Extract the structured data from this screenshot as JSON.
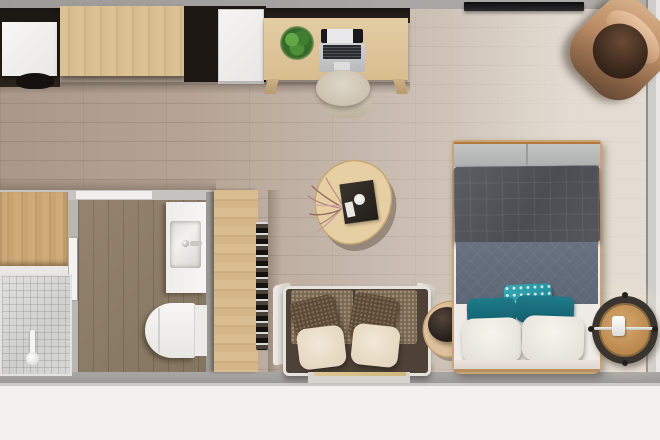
{
  "scene": {
    "title": "Studio apartment top-down 3D floor plan render",
    "view": "bird's-eye interior render, no visible text"
  },
  "palette": {
    "wall_gray": "#a3a19e",
    "wall_light": "#cfcdca",
    "outside_white": "#f2f1ef",
    "floor_main": "#b5a496",
    "floor_light_right": "#dad3ca",
    "floor_bathroom": "#8a7b6c",
    "wood_light": "#d8bd90",
    "dark_unit": "#241f1a",
    "white_fixture": "#f2f1ef",
    "marble_tile": "#dbdbd9",
    "tv_black": "#17171a",
    "armchair_tan": "#b98a63",
    "sofa_tweed_brown": "#7c6952",
    "pillow_dark_brown": "#5c4936",
    "pillow_cream": "#ece1cd",
    "coffee_table_wood": "#e4cda1",
    "copper_accent": "#b97c4c",
    "bench_gray": "#b9baba",
    "duvet_charcoal": "#53555b",
    "blanket_slate": "#646e7b",
    "pillow_teal": "#1a7482",
    "pillow_teal_bright": "#2ba2ae",
    "pillow_white": "#f1eee9",
    "nightstand_wood": "#c89a63",
    "plant_green": "#4e9038"
  },
  "furniture": {
    "kitchen_unit": {
      "label": "Kitchen unit with white counter and stool"
    },
    "wardrobe_top": {
      "label": "Light wood wardrobe along top wall"
    },
    "mini_fridge": {
      "label": "White mini fridge in dark alcove"
    },
    "desk": {
      "label": "Wood desk"
    },
    "laptop": {
      "label": "Open laptop on desk"
    },
    "plant": {
      "label": "Green potted plant on desk"
    },
    "desk_chair": {
      "label": "Beige desk chair"
    },
    "tv": {
      "label": "Wall-mounted flat TV"
    },
    "armchair": {
      "label": "Brown leather corner armchair"
    },
    "coffee_table": {
      "label": "Triangular wood coffee table with dark tray, cup and dried flowers"
    },
    "sofa": {
      "label": "Two-seat sofa with brown tweed backs, brown and cream pillows"
    },
    "side_table": {
      "label": "Triangular side table with dark lamp shade and copper arm"
    },
    "bed": {
      "label": "Double bed with charcoal duvet, slate blanket, teal and white pillows"
    },
    "foot_bench": {
      "label": "Gray bench at foot of bed with copper trim"
    },
    "nightstand": {
      "label": "Round wood nightstand with chrome bar and lamp"
    },
    "closet": {
      "label": "Open closet with clothes hangers"
    },
    "bathroom": {
      "label": "Bathroom with wood floor"
    },
    "vanity": {
      "label": "White vanity with square sink and faucet"
    },
    "toilet": {
      "label": "White toilet with tank"
    },
    "shower": {
      "label": "Marble mosaic shower area with hand shower"
    },
    "bath_cabinet": {
      "label": "Wood cabinet beside shower"
    },
    "window_sill": {
      "label": "Window with wood sill behind sofa"
    }
  }
}
